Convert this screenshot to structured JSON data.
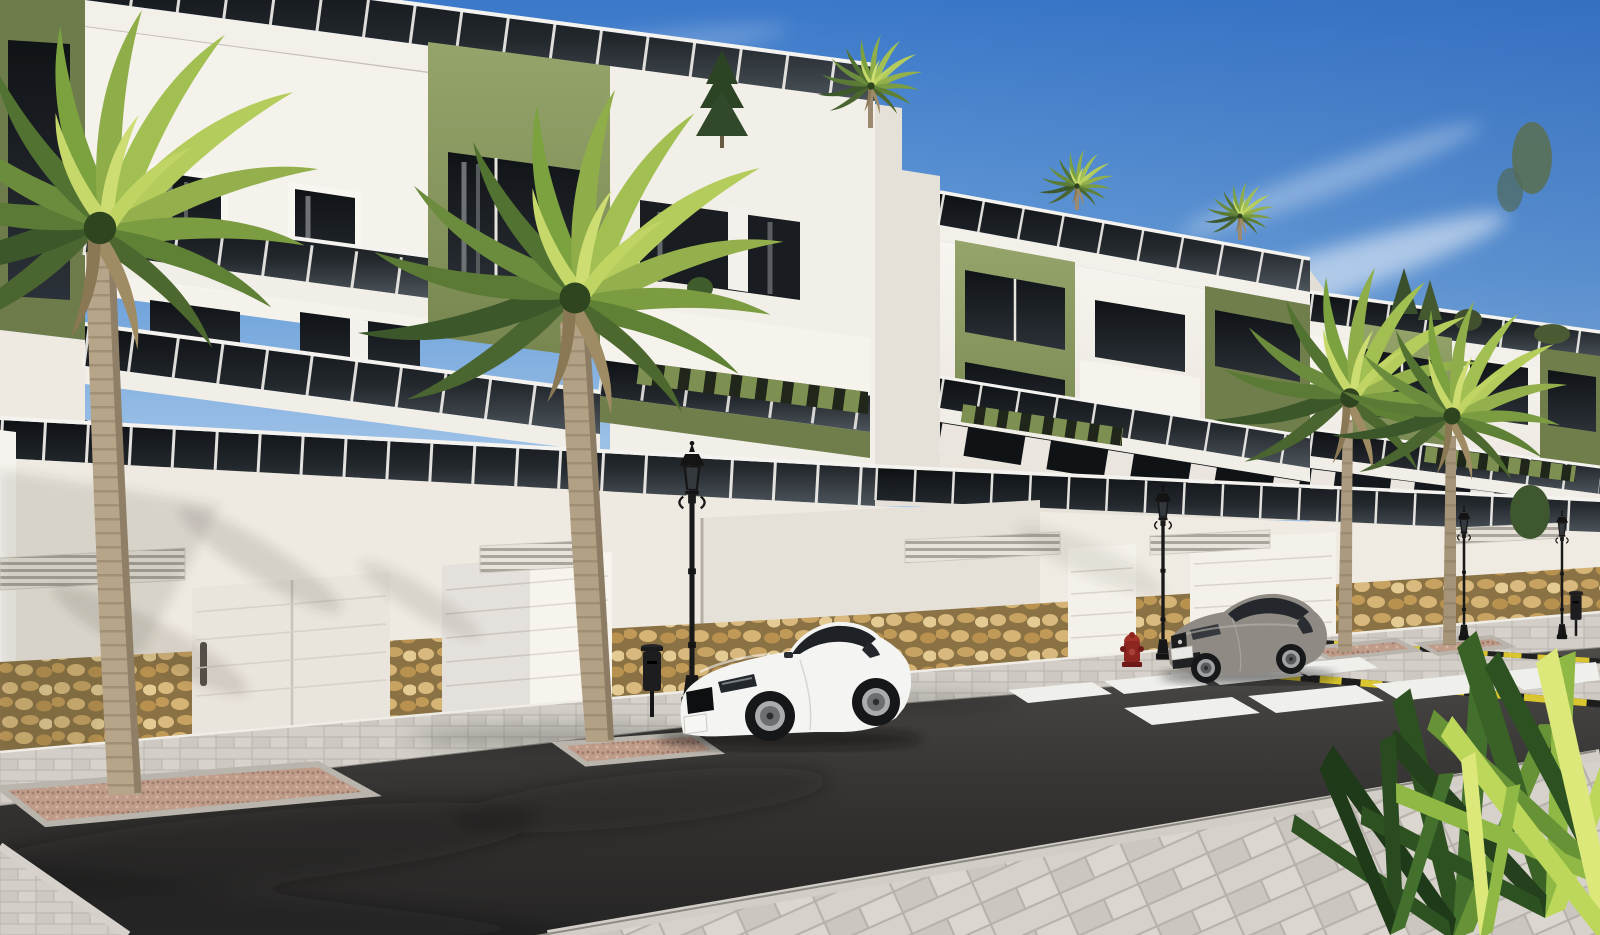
{
  "meta": {
    "type": "3d-architectural-render",
    "description": "Sunny street-level exterior rendering of a modern three-storey apartment complex with white facades and olive-green accent panels, tinted-glass balcony balustrades, green pergola slats, stone-clad garage walls with white sectional doors, tall palm trees, a white sports coupe and a grey coupe parked on a dark asphalt street with a zebra crosswalk, yellow-and-black painted kerbs, classic black lantern street lamps, a red fire hydrant and a pale paved sidewalk in the foreground under a blue sky with wispy clouds."
  },
  "palette": {
    "sky_top": "#3b78c9",
    "sky_horizon": "#cfe2f4",
    "cloud_white": "#ffffff",
    "facade_white": "#f6f3ee",
    "facade_shadow": "#d9d4cc",
    "accent_olive": "#8a9a62",
    "accent_olive_dark": "#707e4c",
    "glass_dark": "#1a1f24",
    "window_dark": "#14171b",
    "stone_tan": "#c9a76b",
    "stone_grout": "#8a7244",
    "garage_white": "#f4f1ea",
    "asphalt_light": "#57544f",
    "asphalt_dark": "#2b2a28",
    "sidewalk_grey": "#d3cfc8",
    "crosswalk_white": "#efefec",
    "curb_yellow": "#d9c52f",
    "curb_black": "#1d1d1d",
    "gravel_pink": "#bf9c8a",
    "palm_dark": "#3e5a2a",
    "palm_mid": "#6f9040",
    "palm_light": "#9ebf4b",
    "palm_sunlit": "#c0d45f",
    "trunk_tan": "#b7a58a",
    "lamp_black": "#191919",
    "hydrant_red": "#8c2420",
    "car_white": "#f4f4f2",
    "car_grey": "#8f8b84",
    "tyre_black": "#17181a",
    "rim_silver": "#a9adb0"
  },
  "scene": {
    "buildings": {
      "blocks": 3,
      "storeys_visible": 3,
      "features": [
        "roof terraces with tinted glass balustrades",
        "olive green accent wall panels",
        "dark tinted windows with curtains",
        "white balcony volumes",
        "green pergola slats over ground-floor terraces",
        "stone veneer base",
        "ventilation grilles",
        "white garage doors"
      ]
    },
    "vehicles": {
      "white_coupe": {
        "label": "white sports coupe",
        "position": "parked left of centre"
      },
      "grey_coupe": {
        "label": "grey coupe",
        "position": "parked right, before crosswalk"
      }
    },
    "street": {
      "lamps": 4,
      "trash_bins": 2,
      "fire_hydrants": 1,
      "crosswalk_stripes": 8,
      "garage_doors": 4,
      "street_palms": 4,
      "planters": 4,
      "kerb_marking": "yellow and black stripes"
    },
    "landscape": {
      "tall_palms": 4,
      "foreground_plant": "fan palm bush, bottom right",
      "rooftop_plants": "small pine, shrubs and mini palms on roof terraces"
    }
  }
}
